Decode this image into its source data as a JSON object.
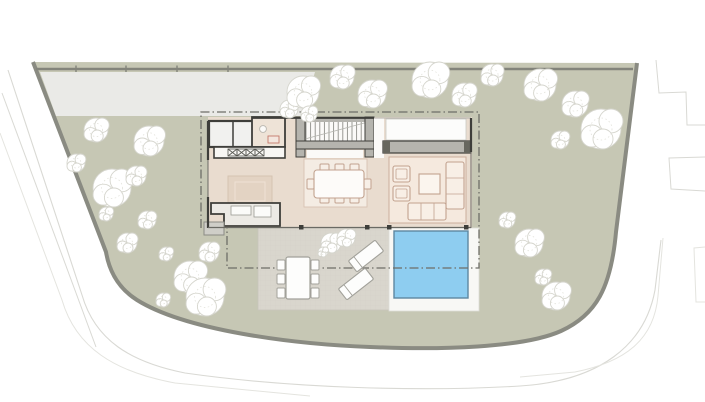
{
  "meta": {
    "page_type": "architectural site plan",
    "visible_text": ""
  },
  "colors": {
    "background": "#ffffff",
    "plot_fill": "#c6c7b4",
    "plot_edge": "#8a8b82",
    "fence_line": "#83847b",
    "driveway_fill": "#eaeae7",
    "road_edge": "#d9d9d4",
    "road_edge_faint": "#e4e4df",
    "terrace_fill": "#d9d6cd",
    "deck_line": "#cbc8bf",
    "floor_fill": "#e9dccf",
    "pantry_fill": "#eee3d7",
    "rug_dining": "#f4ece3",
    "rug_living": "#f5e9de",
    "rug_edge": "#ccae9c",
    "island_fill": "#e3d3c3",
    "wall_dark": "#3e3e3a",
    "wall_grey": "#b5b4ae",
    "wall_grey_dark": "#67675f",
    "furniture_line": "#c2a28f",
    "outdoor_line": "#a2a19a",
    "pool_fill": "#8ecdf0",
    "pool_edge": "#5d87a0",
    "pool_pad": "#f8f8f5",
    "roofline": "#6e6e67",
    "tree_fill": "#ffffff",
    "tree_edge": "#d5d5cd",
    "white_room": "#fbfaf8",
    "appliance_red": "#c4796a",
    "stair_tread": "#8f8f89"
  },
  "site": {
    "fence_ticks": [
      76,
      126,
      177,
      228
    ],
    "trees": [
      [
        96,
        130,
        12
      ],
      [
        76,
        163,
        9
      ],
      [
        112,
        188,
        19
      ],
      [
        149,
        141,
        15
      ],
      [
        136,
        176,
        10
      ],
      [
        106,
        214,
        7
      ],
      [
        147,
        220,
        9
      ],
      [
        127,
        243,
        10
      ],
      [
        166,
        254,
        7
      ],
      [
        190,
        277,
        16
      ],
      [
        209,
        252,
        10
      ],
      [
        205,
        297,
        19
      ],
      [
        163,
        300,
        7
      ],
      [
        289,
        109,
        9
      ],
      [
        303,
        92,
        16
      ],
      [
        342,
        77,
        12
      ],
      [
        372,
        94,
        14
      ],
      [
        309,
        114,
        8
      ],
      [
        430,
        80,
        18
      ],
      [
        464,
        95,
        12
      ],
      [
        492,
        75,
        11
      ],
      [
        540,
        85,
        16
      ],
      [
        575,
        104,
        13
      ],
      [
        601,
        129,
        20
      ],
      [
        560,
        140,
        9
      ],
      [
        529,
        243,
        14
      ],
      [
        507,
        220,
        8
      ],
      [
        556,
        296,
        14
      ],
      [
        543,
        277,
        8
      ]
    ],
    "terrace_shrubs": [
      [
        331,
        243,
        10
      ],
      [
        346,
        238,
        9
      ],
      [
        323,
        252,
        5
      ]
    ]
  },
  "furniture": {
    "dining_chairs": 8,
    "outdoor_chairs": 6,
    "sun_loungers": 2
  }
}
